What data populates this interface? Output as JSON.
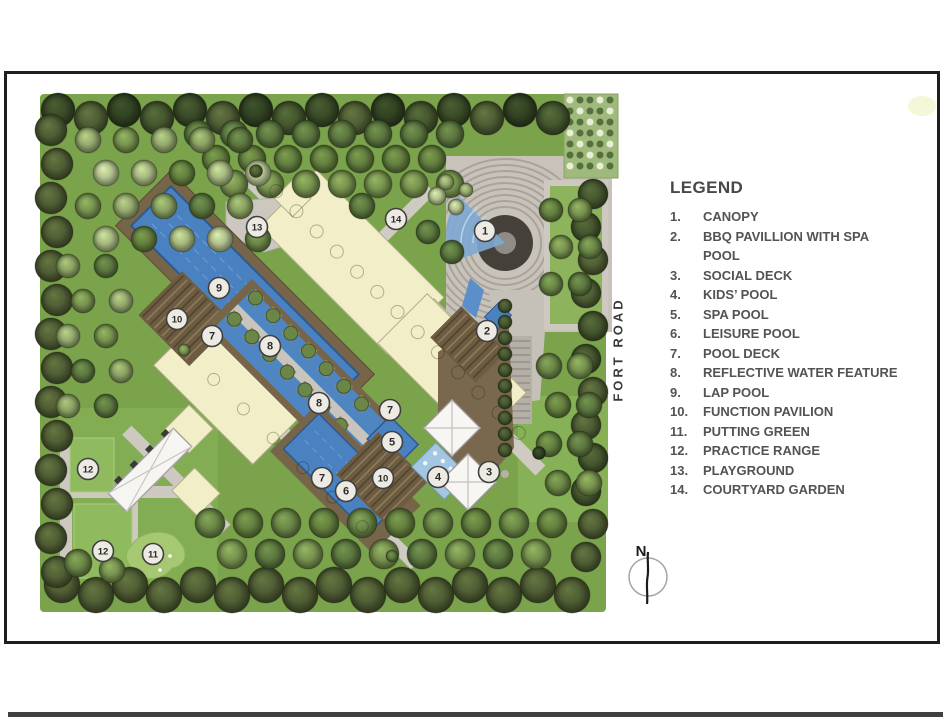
{
  "legend": {
    "title": "LEGEND",
    "items": [
      {
        "num": "1.",
        "label": "CANOPY"
      },
      {
        "num": "2.",
        "label": "BBQ PAVILLION WITH SPA POOL"
      },
      {
        "num": "3.",
        "label": "SOCIAL DECK"
      },
      {
        "num": "4.",
        "label": "KIDS’ POOL"
      },
      {
        "num": "5.",
        "label": "SPA POOL"
      },
      {
        "num": "6.",
        "label": "LEISURE POOL"
      },
      {
        "num": "7.",
        "label": "POOL DECK"
      },
      {
        "num": "8.",
        "label": "REFLECTIVE WATER FEATURE"
      },
      {
        "num": "9.",
        "label": "LAP POOL"
      },
      {
        "num": "10.",
        "label": "FUNCTION PAVILION"
      },
      {
        "num": "11.",
        "label": "PUTTING GREEN"
      },
      {
        "num": "12.",
        "label": "PRACTICE RANGE"
      },
      {
        "num": "13.",
        "label": "PLAYGROUND"
      },
      {
        "num": "14.",
        "label": "COURTYARD GARDEN"
      }
    ]
  },
  "plan": {
    "road_label": "FORT ROAD",
    "compass_label": "N",
    "markers": [
      {
        "n": "1",
        "x": 485,
        "y": 231
      },
      {
        "n": "2",
        "x": 487,
        "y": 331
      },
      {
        "n": "3",
        "x": 489,
        "y": 472
      },
      {
        "n": "4",
        "x": 438,
        "y": 477
      },
      {
        "n": "5",
        "x": 392,
        "y": 442
      },
      {
        "n": "6",
        "x": 346,
        "y": 491
      },
      {
        "n": "7",
        "x": 212,
        "y": 336
      },
      {
        "n": "7",
        "x": 390,
        "y": 410
      },
      {
        "n": "7",
        "x": 322,
        "y": 478
      },
      {
        "n": "8",
        "x": 270,
        "y": 346
      },
      {
        "n": "8",
        "x": 319,
        "y": 403
      },
      {
        "n": "9",
        "x": 219,
        "y": 288
      },
      {
        "n": "10",
        "x": 177,
        "y": 319
      },
      {
        "n": "10",
        "x": 383,
        "y": 478
      },
      {
        "n": "11",
        "x": 153,
        "y": 554
      },
      {
        "n": "12",
        "x": 88,
        "y": 469
      },
      {
        "n": "12",
        "x": 103,
        "y": 551
      },
      {
        "n": "13",
        "x": 257,
        "y": 227
      },
      {
        "n": "14",
        "x": 396,
        "y": 219
      }
    ]
  },
  "colors": {
    "frame_border": "#1f1f1f",
    "lawn": "#7aa34c",
    "pool_blue": "#4a81c0",
    "deck_brown": "#77654a",
    "building_cream": "#f2efc8",
    "path_gray": "#cdc9c1",
    "legend_text": "#4f4f4f",
    "marker_fill": "#edeae4"
  }
}
